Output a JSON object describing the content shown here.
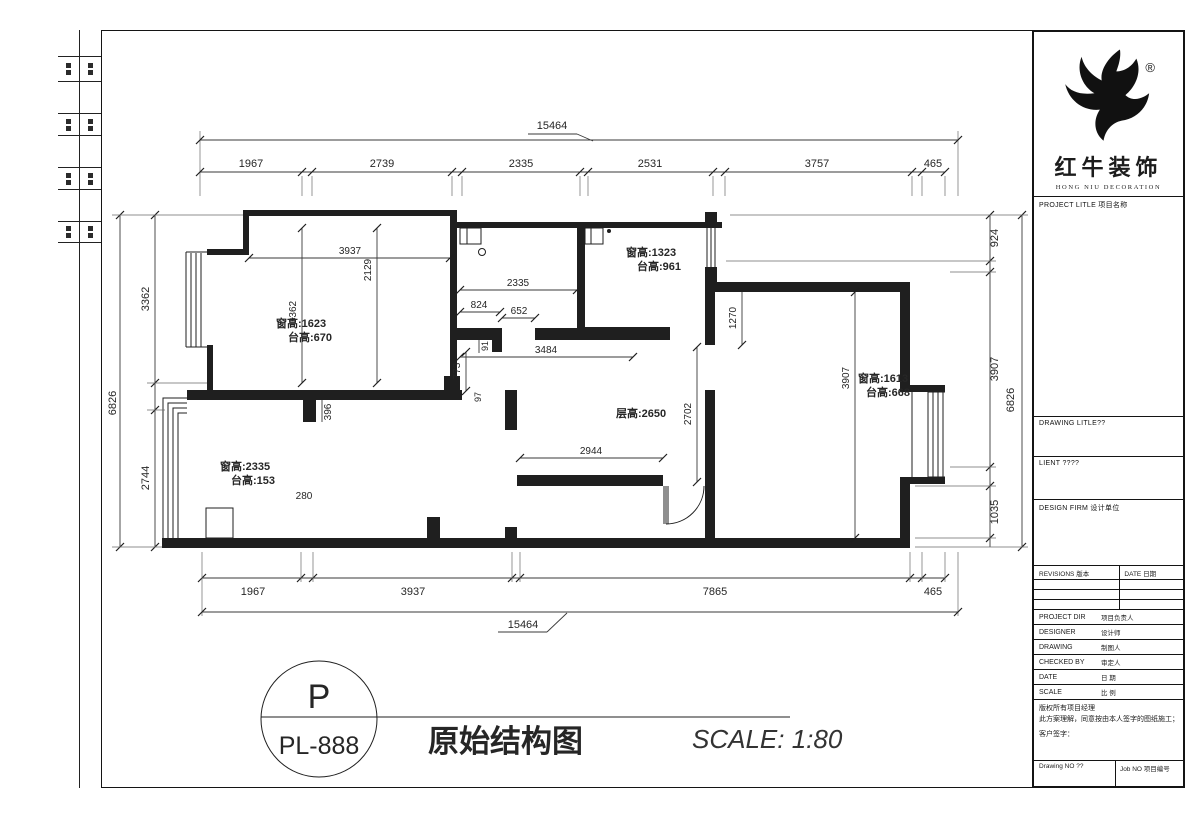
{
  "sheet": {
    "stamp_letter": "P",
    "stamp_number": "PL-888",
    "drawing_title": "原始结构图",
    "scale_text": "SCALE: 1:80"
  },
  "brand": {
    "name_cn": "红牛装饰",
    "name_en": "HONG NIU DECORATION",
    "registered": "®"
  },
  "titleblock": {
    "project_title_label": "PROJECT LITLE 项目名称",
    "drawing_title_label": "DRAWING LITLE??",
    "client_label": "LIENT ????",
    "design_firm_label": "DESIGN FIRM 设计单位",
    "revisions_label": "REVISIONS 版本",
    "revisions_date_label": "DATE 日期",
    "rows": [
      {
        "en": "PROJECT DIR",
        "cn": "项目负责人"
      },
      {
        "en": "DESIGNER",
        "cn": "设计师"
      },
      {
        "en": "DRAWING",
        "cn": "制图人"
      },
      {
        "en": "CHECKED BY",
        "cn": "审定人"
      },
      {
        "en": "DATE",
        "cn": "日 期"
      },
      {
        "en": "SCALE",
        "cn": "比 例"
      }
    ],
    "disclaimer_1": "版权所有项目经理",
    "disclaimer_2": "此方案理解，同意按由本人签字的图纸施工；",
    "disclaimer_3": "客户签字：",
    "drawing_no_label": "Drawing NO ??",
    "job_no_label": "Job NO 项目编号"
  },
  "plan": {
    "overall_width": "15464",
    "top_segments": [
      "1967",
      "2739",
      "2335",
      "2531",
      "3757",
      "465"
    ],
    "bottom_segments": [
      "1967",
      "3937",
      "7865",
      "465"
    ],
    "left_total": "6826",
    "left_upper": "3362",
    "left_lower": "2744",
    "right_total": "6826",
    "right_upper": "924",
    "right_mid": "3907",
    "right_lower": "1035",
    "rooms": {
      "bed1_win": "窗高:1623",
      "bed1_sill": "台高:670",
      "kitchen_win": "窗高:1323",
      "kitchen_sill": "台高:961",
      "bed2_win": "窗高:1613",
      "bed2_sill": "台高:668",
      "living_win": "窗高:2335",
      "living_sill": "台高:153",
      "ceiling": "层高:2650"
    },
    "d": {
      "a3937": "3937",
      "a2129": "2129",
      "a3362": "3362",
      "a2335": "2335",
      "a824": "824",
      "a652": "652",
      "a3484": "3484",
      "a91": "91",
      "a773": "773",
      "a97": "97",
      "a396": "396",
      "a280": "280",
      "a1270": "1270",
      "a2702": "2702",
      "a2944": "2944",
      "a3907": "3907"
    }
  }
}
